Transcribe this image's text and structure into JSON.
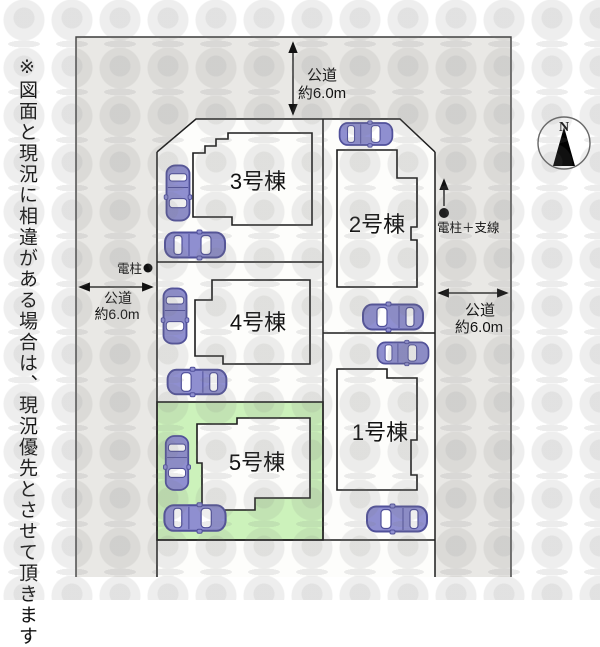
{
  "note": "※図面と現況に相違がある場合は、現況優先とさせて頂きます",
  "roads": {
    "top": {
      "label": "公道",
      "width": "約6.0m"
    },
    "left": {
      "label": "公道",
      "width": "約6.0m"
    },
    "right": {
      "label": "公道",
      "width": "約6.0m"
    }
  },
  "poles": {
    "left": {
      "label": "電柱"
    },
    "right": {
      "label": "電柱＋支線"
    }
  },
  "compass": {
    "north": "N"
  },
  "lots": [
    {
      "label": "1号棟",
      "highlighted": false
    },
    {
      "label": "2号棟",
      "highlighted": false
    },
    {
      "label": "3号棟",
      "highlighted": false
    },
    {
      "label": "4号棟",
      "highlighted": false
    },
    {
      "label": "5号棟",
      "highlighted": true
    }
  ],
  "colors": {
    "road": "#e9e8e5",
    "lot": "#fdfdfb",
    "highlight_green": "#ccf2bb",
    "car_body": "#8f8fd0",
    "car_outline": "#50509a",
    "line": "#1c1c1c"
  },
  "car_count": 10
}
